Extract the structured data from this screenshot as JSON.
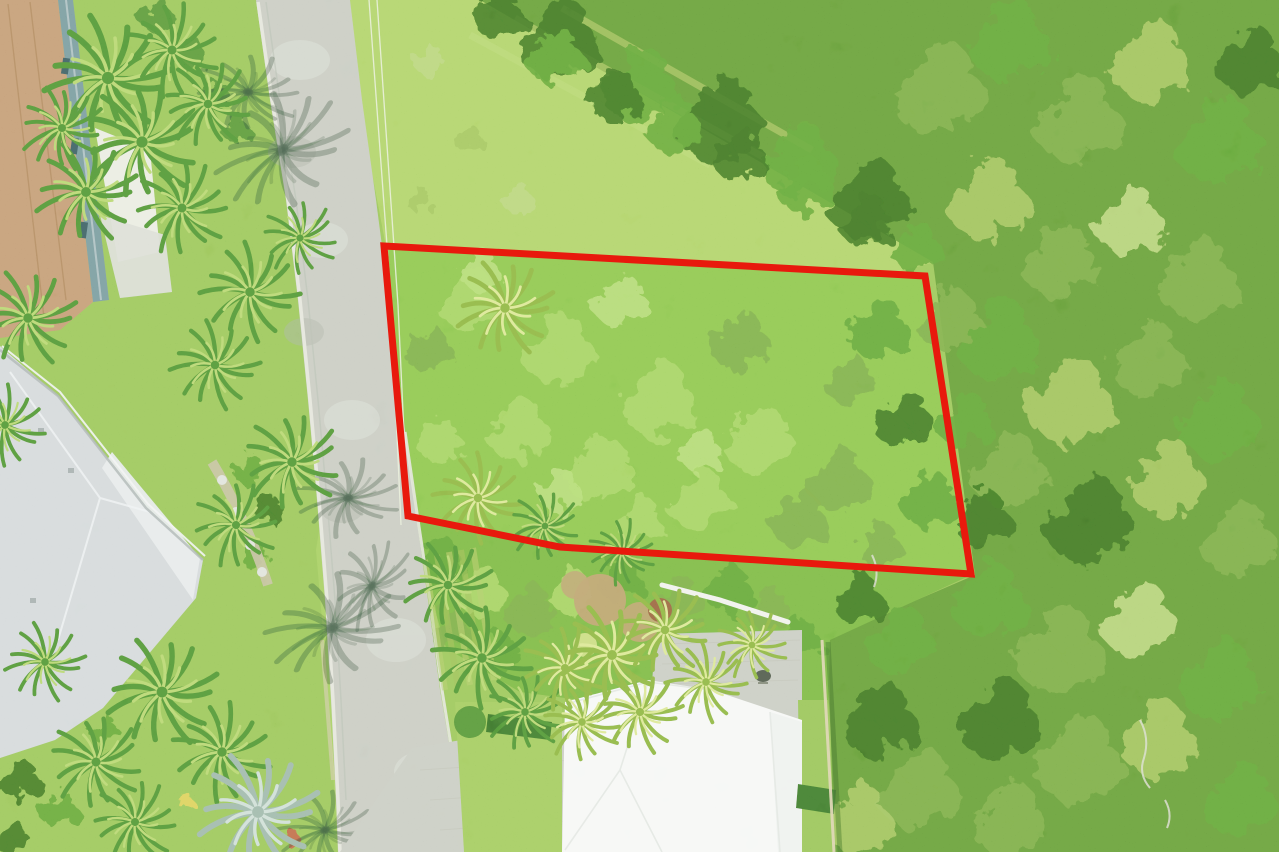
{
  "meta": {
    "title": "Aerial drone photo of a vacant residential lot outlined in red, bordered by a street, palm-landscaped homes and dense green woodland",
    "width": 1279,
    "height": 852,
    "visible_text": "none"
  },
  "palette": {
    "lawn": "#7cb348",
    "meadow": "#97c454",
    "verge": "#8abd4e",
    "forest": "#4f7f2d",
    "parcel_veg": "#6db33e",
    "scrub": "#5fa136",
    "road": "#b7bab2",
    "road_light": "#d0d3cc",
    "road_dark": "#8f958c",
    "curb": "#dcdcd2",
    "pavers": "#b8bbb3",
    "paver_joint": "#a6a99f",
    "roof_white": "#f3f5f3",
    "roof_white_shade": "#e9edeb",
    "roof_gray": "#c6ccd0",
    "roof_gray_light": "#dfe4e6",
    "roof_terracotta": "#b07b5e",
    "roof_terracotta_dark": "#8a5d42",
    "wall_teal": "#5c7a86",
    "patio_white": "#e9e8e2",
    "patio_gray": "#cfd2ca",
    "fence_tan": "#d4c59c",
    "mulch": "#a8845a",
    "path_white": "#edeee8",
    "stone_path": "#b9ab8c",
    "boundary_red": "#e8190d",
    "power_line": "#e4ecd2",
    "shadow_green": "rgba(35,55,45,0.5)"
  },
  "boundary": {
    "points": "384,246 925,276 971,574 560,547 408,516",
    "color": "#e8190d",
    "stroke_width": 7
  },
  "regions": {
    "road": "256,0 270,100 286,200 298,300 308,400 317,500 325,600 331,700 336,800 338,852 460,852 452,760 440,690 428,600 414,500 401,400 389,300 376,200 362,100 350,0",
    "meadow": "350,0 480,0 935,262 897,272 386,247 362,120",
    "verge": "364,246 390,246 413,518 449,742 456,852 338,852 328,690 316,550",
    "forest": "480,0 1279,0 1279,852 834,852 828,638 975,575 933,262",
    "parcel": "384,246 925,276 971,574 560,547 408,516",
    "scrub": "408,517 560,548 969,576 830,640 828,726 640,708 520,692 446,648",
    "driveway": "412,748 505,733 585,725 650,707 656,634 802,630 802,852 340,852",
    "lawn_left_of_house": "455,702 562,702 562,852 464,852",
    "lawn_right_of_house": "798,700 828,700 833,852 800,852",
    "roof_white": "565,702 648,680 712,690 802,720 802,852 562,852",
    "roof_white_right_wing": "770,712 802,722 802,852 778,852",
    "roof_gray": "0,346 60,398 148,510 203,560 196,598 103,708 55,740 0,758",
    "roof_gray_lanai": "112,452 200,558 193,600 102,468",
    "roof_terracotta": "0,0 58,0 93,302 60,330 0,338",
    "wall_teal": "58,0 73,0 109,300 93,302",
    "patio_white": "95,128 150,150 160,252 118,262",
    "patio_gray": "100,215 165,235 172,292 120,298",
    "hedge_near_driveway": "488,714 552,722 550,740 486,732",
    "hedge_right_of_house": "798,784 836,790 834,814 796,808"
  },
  "power_lines": {
    "wire1": "M369,0 L391,300 L401,525",
    "wire2": "M377,0 L398,305 L408,520"
  },
  "veg_palette": [
    "#8cc651",
    "#4e8a2e",
    "#3c7326",
    "#9ed05f",
    "#62933a",
    "#2f5a1d",
    "#86b14e",
    "#a3c766",
    "#b04a3a",
    "#d8c24a",
    "#41742c"
  ],
  "blob_groups": [
    {
      "name": "forest-canopy",
      "items": [
        [
          560,
          40,
          2.6,
          5
        ],
        [
          640,
          85,
          2.4,
          1
        ],
        [
          720,
          120,
          2.8,
          5
        ],
        [
          800,
          160,
          2.4,
          1
        ],
        [
          870,
          200,
          2.6,
          5
        ],
        [
          940,
          90,
          3.0,
          4
        ],
        [
          1010,
          40,
          2.6,
          1
        ],
        [
          1080,
          120,
          2.8,
          4
        ],
        [
          1150,
          60,
          2.6,
          6
        ],
        [
          1220,
          140,
          2.8,
          1
        ],
        [
          990,
          200,
          2.6,
          6
        ],
        [
          1060,
          260,
          2.4,
          4
        ],
        [
          1130,
          220,
          2.2,
          7
        ],
        [
          1200,
          280,
          2.6,
          4
        ],
        [
          1250,
          60,
          2.2,
          5
        ],
        [
          1000,
          340,
          2.6,
          1
        ],
        [
          1070,
          400,
          2.8,
          6
        ],
        [
          1150,
          360,
          2.4,
          4
        ],
        [
          1220,
          420,
          2.6,
          1
        ],
        [
          1010,
          470,
          2.4,
          4
        ],
        [
          1090,
          520,
          2.8,
          5
        ],
        [
          1170,
          480,
          2.4,
          6
        ],
        [
          1240,
          540,
          2.4,
          4
        ],
        [
          990,
          600,
          2.4,
          1
        ],
        [
          1060,
          650,
          2.8,
          4
        ],
        [
          1140,
          620,
          2.4,
          7
        ],
        [
          1220,
          680,
          2.6,
          1
        ],
        [
          1000,
          720,
          2.6,
          5
        ],
        [
          1080,
          760,
          2.8,
          4
        ],
        [
          1160,
          740,
          2.4,
          6
        ],
        [
          1240,
          800,
          2.4,
          1
        ],
        [
          1010,
          820,
          2.4,
          4
        ],
        [
          900,
          640,
          2.2,
          1
        ],
        [
          880,
          720,
          2.4,
          5
        ],
        [
          920,
          790,
          2.6,
          4
        ],
        [
          860,
          820,
          2.2,
          6
        ],
        [
          950,
          320,
          2.0,
          4
        ],
        [
          965,
          420,
          1.8,
          1
        ],
        [
          985,
          520,
          1.8,
          5
        ]
      ]
    },
    {
      "name": "treeline-edge",
      "items": [
        [
          500,
          15,
          1.6,
          5
        ],
        [
          555,
          55,
          1.8,
          1
        ],
        [
          615,
          95,
          1.7,
          5
        ],
        [
          675,
          125,
          1.8,
          1
        ],
        [
          740,
          155,
          1.7,
          5
        ],
        [
          805,
          185,
          1.8,
          1
        ],
        [
          868,
          222,
          1.7,
          5
        ],
        [
          918,
          248,
          1.6,
          1
        ]
      ]
    },
    {
      "name": "parcel-dark-trees",
      "items": [
        [
          880,
          330,
          2.0,
          1
        ],
        [
          905,
          420,
          1.9,
          5
        ],
        [
          930,
          500,
          1.8,
          1
        ],
        [
          850,
          380,
          1.6,
          4
        ]
      ]
    },
    {
      "name": "parcel-shrubs",
      "items": [
        [
          470,
          300,
          2.0,
          0
        ],
        [
          560,
          350,
          2.3,
          0
        ],
        [
          660,
          400,
          2.4,
          0
        ],
        [
          760,
          440,
          2.2,
          0
        ],
        [
          840,
          480,
          2.0,
          4
        ],
        [
          520,
          430,
          2.0,
          0
        ],
        [
          600,
          470,
          2.2,
          0
        ],
        [
          700,
          500,
          2.0,
          0
        ],
        [
          800,
          520,
          1.8,
          4
        ],
        [
          740,
          340,
          1.9,
          4
        ],
        [
          620,
          300,
          1.7,
          3
        ],
        [
          480,
          270,
          1.3,
          3
        ],
        [
          700,
          450,
          1.4,
          3
        ],
        [
          560,
          490,
          1.4,
          3
        ],
        [
          430,
          350,
          1.5,
          4
        ],
        [
          440,
          440,
          1.4,
          0
        ],
        [
          880,
          545,
          1.4,
          4
        ],
        [
          640,
          520,
          1.5,
          0
        ]
      ]
    },
    {
      "name": "scrub-below-parcel",
      "items": [
        [
          440,
          560,
          1.5,
          1
        ],
        [
          480,
          590,
          1.6,
          0
        ],
        [
          530,
          610,
          1.6,
          4
        ],
        [
          570,
          590,
          1.4,
          0
        ],
        [
          620,
          580,
          1.4,
          1
        ],
        [
          680,
          600,
          1.5,
          4
        ],
        [
          730,
          590,
          1.5,
          1
        ],
        [
          770,
          610,
          1.4,
          4
        ],
        [
          800,
          640,
          1.4,
          1
        ],
        [
          860,
          600,
          1.6,
          5
        ],
        [
          450,
          630,
          1.3,
          4
        ],
        [
          500,
          655,
          1.3,
          1
        ]
      ]
    },
    {
      "name": "meadow-tufts",
      "items": [
        [
          430,
          60,
          1.0,
          7
        ],
        [
          470,
          140,
          0.9,
          6
        ],
        [
          520,
          200,
          1.0,
          7
        ],
        [
          420,
          200,
          0.8,
          6
        ]
      ]
    },
    {
      "name": "left-garden-shrubs",
      "items": [
        [
          20,
          80,
          1.4,
          5
        ],
        [
          45,
          120,
          1.2,
          1
        ],
        [
          15,
          160,
          1.2,
          5
        ],
        [
          250,
          470,
          1.0,
          1
        ],
        [
          270,
          510,
          0.9,
          5
        ],
        [
          255,
          555,
          0.9,
          1
        ],
        [
          30,
          560,
          0.8,
          1
        ],
        [
          20,
          780,
          1.3,
          5
        ],
        [
          60,
          810,
          1.2,
          1
        ],
        [
          15,
          840,
          1.1,
          5
        ],
        [
          185,
          800,
          0.5,
          9
        ],
        [
          292,
          838,
          0.55,
          8
        ],
        [
          105,
          730,
          0.9,
          1
        ]
      ]
    },
    {
      "name": "hedgerow-top-left",
      "items": [
        [
          158,
          16,
          1.1,
          10
        ],
        [
          190,
          54,
          1.1,
          10
        ],
        [
          214,
          94,
          1.0,
          10
        ],
        [
          236,
          128,
          0.9,
          10
        ]
      ]
    }
  ],
  "palms": [
    [
      108,
      78,
      1.35,
      10,
      "dark"
    ],
    [
      172,
      50,
      1.0,
      40,
      "dark"
    ],
    [
      142,
      142,
      1.25,
      -15,
      "dark"
    ],
    [
      208,
      104,
      0.95,
      70,
      "dark"
    ],
    [
      86,
      192,
      1.1,
      0,
      "dark"
    ],
    [
      182,
      208,
      1.0,
      55,
      "dark"
    ],
    [
      250,
      292,
      1.05,
      20,
      "dark"
    ],
    [
      300,
      238,
      0.8,
      -30,
      "dark"
    ],
    [
      62,
      128,
      0.9,
      90,
      "dark"
    ],
    [
      28,
      318,
      1.05,
      0,
      "dark"
    ],
    [
      5,
      425,
      0.85,
      30,
      "dark"
    ],
    [
      215,
      365,
      0.95,
      15,
      "dark"
    ],
    [
      292,
      462,
      1.05,
      -20,
      "dark"
    ],
    [
      236,
      525,
      0.9,
      50,
      "dark"
    ],
    [
      162,
      692,
      1.2,
      0,
      "dark"
    ],
    [
      222,
      752,
      1.05,
      35,
      "dark"
    ],
    [
      96,
      762,
      1.0,
      -25,
      "dark"
    ],
    [
      45,
      662,
      0.85,
      10,
      "dark"
    ],
    [
      135,
      822,
      0.9,
      60,
      "dark"
    ],
    [
      258,
      812,
      1.3,
      0,
      "silver"
    ],
    [
      448,
      585,
      0.95,
      0,
      "dark"
    ],
    [
      482,
      658,
      1.05,
      30,
      "dark"
    ],
    [
      525,
      712,
      0.85,
      -15,
      "dark"
    ],
    [
      565,
      668,
      0.9,
      45,
      "yellow"
    ],
    [
      612,
      655,
      1.1,
      0,
      "yellow"
    ],
    [
      665,
      630,
      0.95,
      70,
      "yellow"
    ],
    [
      706,
      682,
      0.85,
      20,
      "yellow"
    ],
    [
      752,
      645,
      0.75,
      -40,
      "yellow"
    ],
    [
      640,
      712,
      0.9,
      10,
      "yellow"
    ],
    [
      582,
      722,
      0.85,
      -30,
      "yellow"
    ],
    [
      505,
      308,
      1.05,
      0,
      "yellow"
    ],
    [
      478,
      498,
      0.95,
      25,
      "yellow"
    ],
    [
      545,
      526,
      0.75,
      -20,
      "dark"
    ],
    [
      622,
      552,
      0.7,
      40,
      "dark"
    ],
    [
      282,
      150,
      1.3,
      0,
      "shadow"
    ],
    [
      248,
      92,
      0.95,
      45,
      "shadow"
    ],
    [
      332,
      628,
      1.25,
      15,
      "shadow"
    ],
    [
      372,
      586,
      0.9,
      -25,
      "shadow"
    ],
    [
      348,
      498,
      0.95,
      30,
      "shadow"
    ],
    [
      325,
      830,
      0.9,
      20,
      "shadow"
    ]
  ],
  "palm_variants": {
    "dark": [
      "#3c732a",
      "#a0c95a"
    ],
    "yellow": [
      "#6d9c35",
      "#cfe07a"
    ],
    "silver": [
      "#7fa095",
      "#bfd3ca"
    ],
    "shadow": [
      "rgba(35,55,45,0.5)",
      "rgba(35,55,45,0.32)"
    ]
  }
}
